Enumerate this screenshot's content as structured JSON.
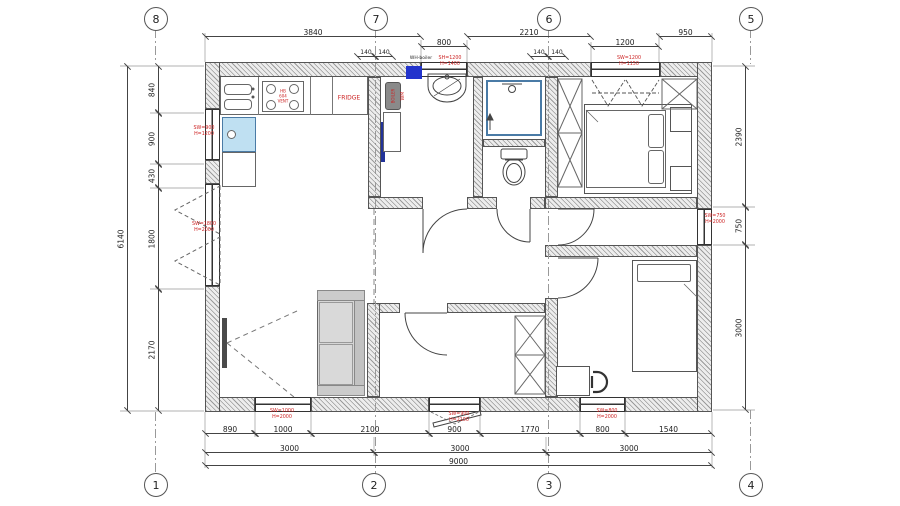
{
  "drawing": {
    "type": "floor-plan",
    "colors": {
      "annotation_red": "#cc2222",
      "shower_border_blue": "#4a7ba6",
      "wm_fill_blue": "#bfe0f2",
      "panel_blue": "#2233cc",
      "radiator_blue": "#223399",
      "wall_line": "#555"
    }
  },
  "labels": {
    "fridge": "FRIDGE",
    "stove": "HB\n604\nVENT",
    "boiler": "BOILER",
    "washer": "WM",
    "water_heater": "WH-boiler"
  },
  "grid_bubbles": [
    {
      "label": "8",
      "x": 155,
      "y": 18
    },
    {
      "label": "7",
      "x": 375,
      "y": 18
    },
    {
      "label": "6",
      "x": 548,
      "y": 18
    },
    {
      "label": "5",
      "x": 750,
      "y": 18
    },
    {
      "label": "1",
      "x": 155,
      "y": 484
    },
    {
      "label": "2",
      "x": 373,
      "y": 484
    },
    {
      "label": "3",
      "x": 548,
      "y": 484
    },
    {
      "label": "4",
      "x": 750,
      "y": 484
    }
  ],
  "dimensions": [
    {
      "dir": "h",
      "label": "3840",
      "x1": 205,
      "x2": 421,
      "y": 36
    },
    {
      "dir": "h",
      "label": "2210",
      "x1": 467,
      "x2": 591,
      "y": 36
    },
    {
      "dir": "h",
      "label": "950",
      "x1": 659,
      "x2": 712,
      "y": 36
    },
    {
      "dir": "h",
      "label": "800",
      "x1": 421,
      "x2": 467,
      "y": 46
    },
    {
      "dir": "h",
      "label": "1200",
      "x1": 591,
      "x2": 659,
      "y": 46
    },
    {
      "dir": "h",
      "label": "140",
      "x1": 357,
      "x2": 375,
      "y": 56,
      "fs": 6
    },
    {
      "dir": "h",
      "label": "140",
      "x1": 375,
      "x2": 393,
      "y": 56,
      "fs": 6
    },
    {
      "dir": "h",
      "label": "140",
      "x1": 530,
      "x2": 548,
      "y": 56,
      "fs": 6
    },
    {
      "dir": "h",
      "label": "140",
      "x1": 548,
      "x2": 566,
      "y": 56,
      "fs": 6
    },
    {
      "dir": "v",
      "label": "840",
      "y1": 66,
      "y2": 113,
      "x": 158
    },
    {
      "dir": "v",
      "label": "900",
      "y1": 113,
      "y2": 164,
      "x": 158
    },
    {
      "dir": "v",
      "label": "430",
      "y1": 164,
      "y2": 188,
      "x": 158
    },
    {
      "dir": "v",
      "label": "1800",
      "y1": 188,
      "y2": 289,
      "x": 158
    },
    {
      "dir": "v",
      "label": "2170",
      "y1": 289,
      "y2": 411,
      "x": 158
    },
    {
      "dir": "v",
      "label": "6140",
      "y1": 66,
      "y2": 411,
      "x": 127
    },
    {
      "dir": "v",
      "label": "2390",
      "y1": 66,
      "y2": 207,
      "x": 745
    },
    {
      "dir": "v",
      "label": "750",
      "y1": 207,
      "y2": 245,
      "x": 745
    },
    {
      "dir": "v",
      "label": "3000",
      "y1": 245,
      "y2": 410,
      "x": 745
    },
    {
      "dir": "h",
      "label": "890",
      "x1": 205,
      "x2": 255,
      "y": 433
    },
    {
      "dir": "h",
      "label": "1000",
      "x1": 255,
      "x2": 311,
      "y": 433
    },
    {
      "dir": "h",
      "label": "2100",
      "x1": 311,
      "x2": 429,
      "y": 433
    },
    {
      "dir": "h",
      "label": "900",
      "x1": 429,
      "x2": 480,
      "y": 433
    },
    {
      "dir": "h",
      "label": "1770",
      "x1": 480,
      "x2": 580,
      "y": 433
    },
    {
      "dir": "h",
      "label": "800",
      "x1": 580,
      "x2": 625,
      "y": 433
    },
    {
      "dir": "h",
      "label": "1540",
      "x1": 625,
      "x2": 712,
      "y": 433
    },
    {
      "dir": "h",
      "label": "3000",
      "x1": 205,
      "x2": 374,
      "y": 452
    },
    {
      "dir": "h",
      "label": "3000",
      "x1": 374,
      "x2": 546,
      "y": 452
    },
    {
      "dir": "h",
      "label": "3000",
      "x1": 546,
      "x2": 712,
      "y": 452
    },
    {
      "dir": "h",
      "label": "9000",
      "x1": 205,
      "x2": 712,
      "y": 465
    }
  ],
  "annotations": [
    {
      "text": "SW=900\nH=1200",
      "x": 204,
      "y": 132
    },
    {
      "text": "SW=1800\nH=2000",
      "x": 204,
      "y": 228
    },
    {
      "text": "SH=1200\nH=1400",
      "x": 450,
      "y": 62
    },
    {
      "text": "SW=1200\nH=1150",
      "x": 629,
      "y": 62
    },
    {
      "text": "SW=750\nH=2000",
      "x": 715,
      "y": 220
    },
    {
      "text": "SW=1000\nH=2000",
      "x": 282,
      "y": 415
    },
    {
      "text": "SW=900\nH=2100",
      "x": 459,
      "y": 418
    },
    {
      "text": "SW=800\nH=2000",
      "x": 607,
      "y": 415
    },
    {
      "text": "WM",
      "x": 404,
      "y": 96,
      "vertical": true
    },
    {
      "text": "BOILER",
      "x": 393,
      "y": 96,
      "vertical": true,
      "fs": 4
    },
    {
      "text": "WH-boiler",
      "x": 421,
      "y": 59,
      "color": "#222",
      "fs": 4.5
    },
    {
      "text": "HB\n604\nVENT",
      "x": 283,
      "y": 96,
      "fs": 4
    },
    {
      "text": "FRIDGE",
      "x": 349,
      "y": 98,
      "fs": 6
    }
  ]
}
